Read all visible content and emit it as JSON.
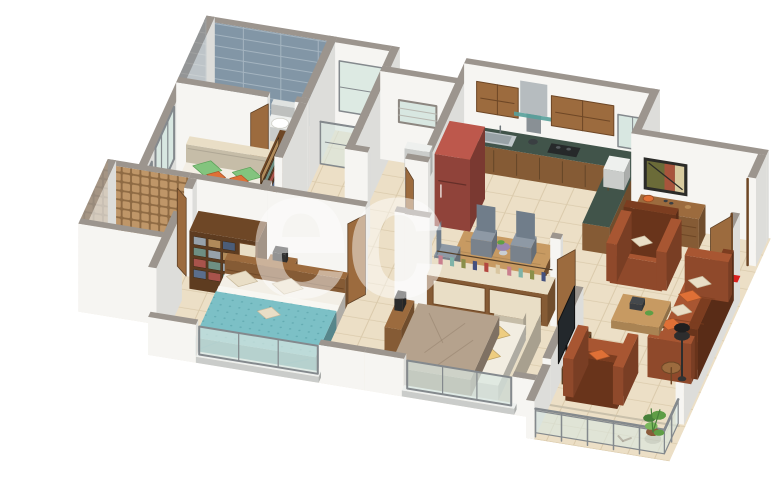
{
  "scene": {
    "type": "3d-floor-plan-render",
    "description": "Isometric 3D render of a 3BHK apartment floor plan on white background",
    "background": "#ffffff",
    "watermark_text": "ec"
  },
  "palette": {
    "wall_face": "#f6f5f2",
    "wall_top": "#9c958e",
    "floor": "#ecdfc6",
    "tile_line": "#d6c5a5",
    "bath_tile": "#8296a6",
    "bath_tile_line": "#a4b4c0",
    "mosaic": "#bf9668",
    "mosaic_line": "#8e6a43",
    "shower": "#9aa0a1",
    "checker_light": "#e4dac8",
    "checker_dark": "#cfc4ae",
    "wood": "#9c6b3e",
    "wood_dark": "#6e4726",
    "wood_light": "#c79a62",
    "cream": "#e9dec6",
    "counter": "#41544a",
    "steel": "#aeb6ba",
    "fridge": "#a94f44",
    "green": "#83c47e",
    "green_dark": "#5a9f57",
    "orange": "#df7036",
    "teal": "#7cc0c6",
    "teal_dark": "#4f98a0",
    "taupe": "#b5a28d",
    "taupe_dark": "#97846f",
    "yellow": "#eecd80",
    "rust": "#a85632",
    "rust_dark": "#7c3d20",
    "chair_grey": "#8e99a5",
    "chair_grey_dark": "#707d8a",
    "rug": "#b8afa1",
    "rug_line": "#a49a8b",
    "glass": "#d8e7e1",
    "rail": "#84898d",
    "red": "#d81f1f",
    "plant": "#5f9e46",
    "plant_dark": "#47803a",
    "plant_light": "#7ab85c",
    "tv": "#23282c",
    "mat": "#b5ad9e",
    "balcony_tile": "#e0d9c7",
    "white_fixture": "#eef0ee",
    "stone": "#c8b089"
  },
  "rooms": {
    "master_bathroom": {
      "items": [
        "blue-wall-tiles",
        "washbasin-cabinet",
        "toilet",
        "wooden-door"
      ]
    },
    "master_bedroom": {
      "items": [
        "double-bed-green",
        "orange-pillows",
        "beige-headboard",
        "tv-dresser",
        "wardrobe-shelves",
        "west-windows",
        "wooden-door"
      ]
    },
    "utility_duct": {
      "items": [
        "glass-partition",
        "railing"
      ]
    },
    "common_toilet": {
      "items": [
        "wall-hung-toilet",
        "vent-window",
        "checker-tile-floor",
        "wooden-door"
      ]
    },
    "kitchen": {
      "items": [
        "upper-cabinets",
        "chimney-hood",
        "glass-shelf",
        "green-granite-counter",
        "steel-sink",
        "hob",
        "kettle",
        "lower-cabinets",
        "red-refrigerator",
        "white-appliance",
        "window"
      ]
    },
    "dining_area": {
      "items": [
        "wooden-dining-table",
        "grey-chairs",
        "plant-centerpiece",
        "crockery-cabinet-with-bottles"
      ]
    },
    "living_room": {
      "items": [
        "rust-sofa-3-seat",
        "rust-armchairs",
        "cream-orange-cushions",
        "wooden-coffee-table",
        "patterned-rug",
        "floor-lamp",
        "side-table",
        "tv-on-half-wall",
        "wall-art",
        "sideboard-with-decor",
        "entrance-door",
        "red-entry-arrow",
        "doormat"
      ]
    },
    "bedroom_2": {
      "items": [
        "double-bed-teal",
        "beige-pillows",
        "open-wardrobe-clothes",
        "dresser",
        "south-window"
      ]
    },
    "bathroom_2": {
      "items": [
        "mosaic-wall-tiles",
        "stone-washbasin",
        "shower-area",
        "glass-screen",
        "wooden-door"
      ]
    },
    "bedroom_3": {
      "items": [
        "double-bed-taupe",
        "yellow-pillows",
        "cream-bed-frame",
        "bar-cabinet-with-bottles",
        "study-desk",
        "tv-panel",
        "south-window",
        "wooden-door"
      ]
    },
    "balcony": {
      "items": [
        "glass-railing",
        "steel-posts",
        "floor-tiles",
        "potted-plant"
      ]
    }
  }
}
